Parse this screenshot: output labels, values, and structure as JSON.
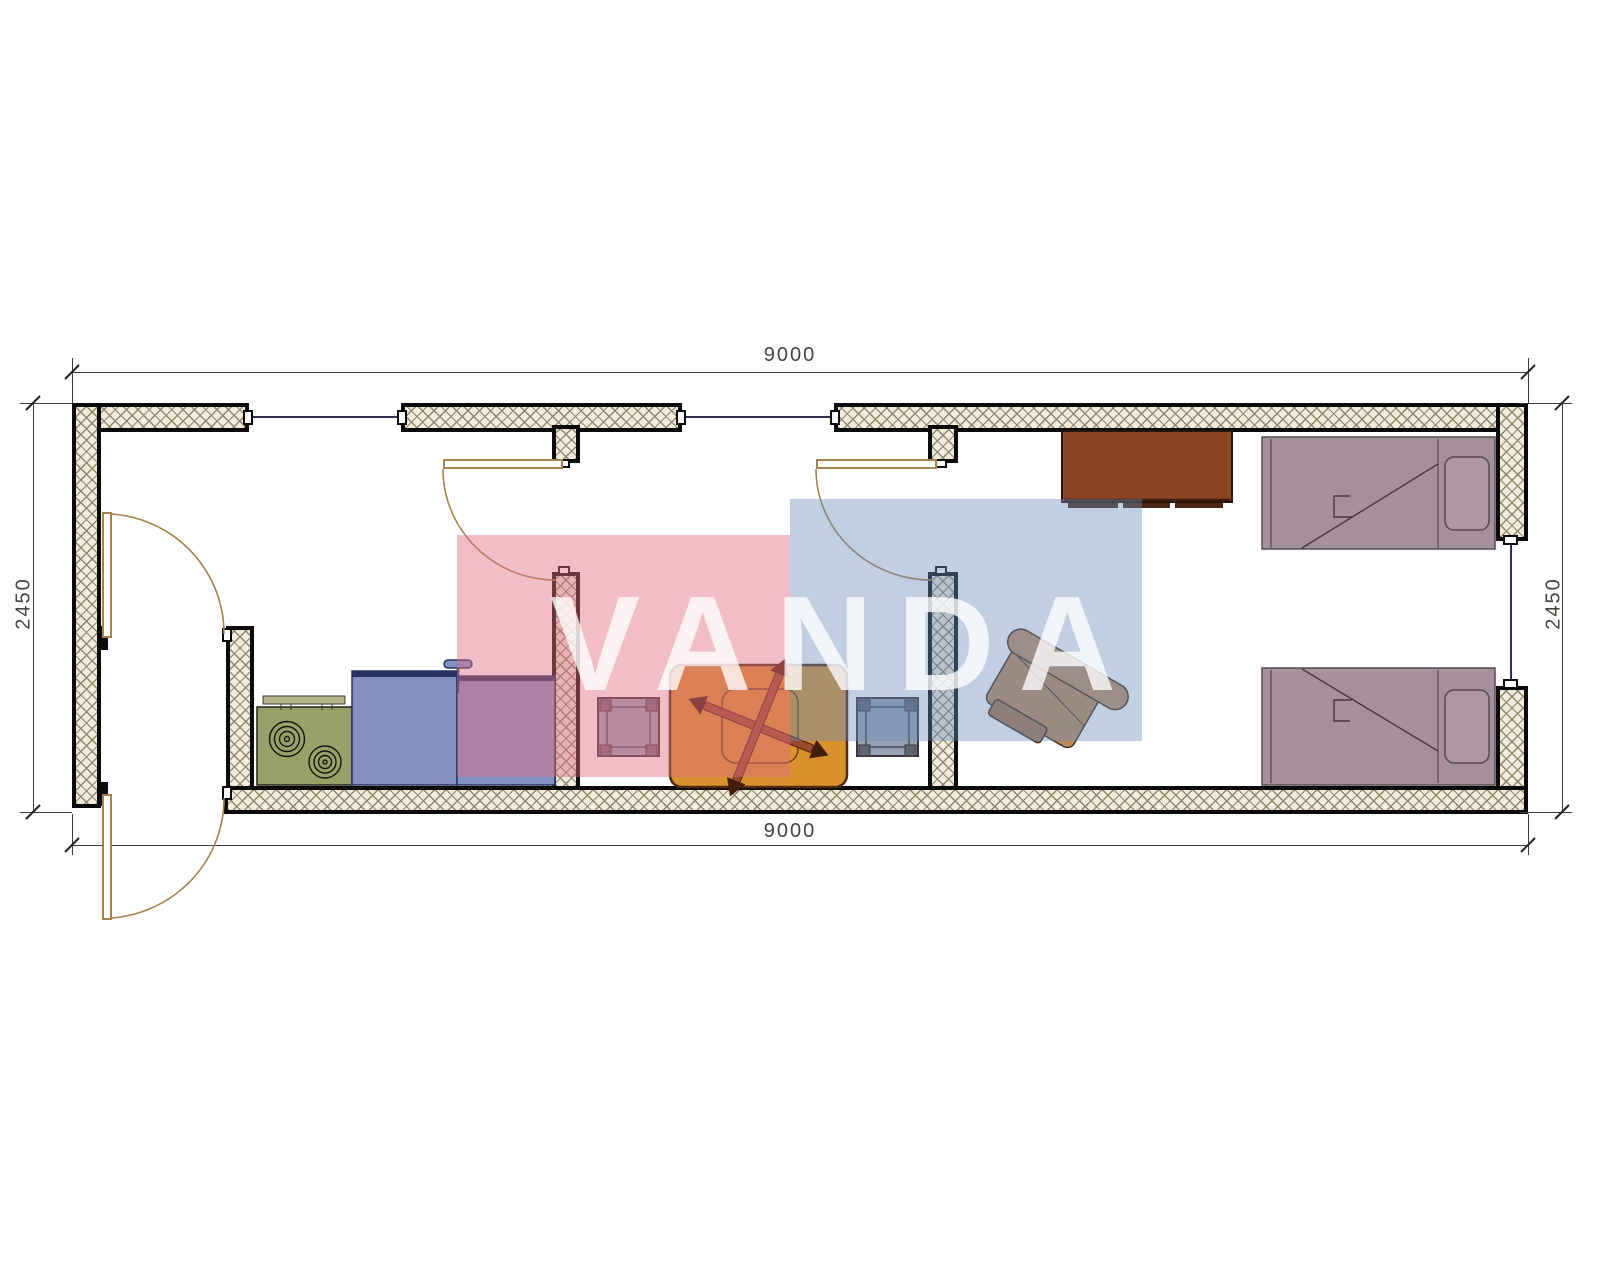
{
  "watermark": {
    "text": "VANDA"
  },
  "dimensions": {
    "top": {
      "label": "9000"
    },
    "bottom": {
      "label": "9000"
    },
    "left": {
      "label": "2450"
    },
    "right": {
      "label": "2450"
    }
  },
  "colors": {
    "wall_fill": "#f0ebdb",
    "hatch_line": "#8f8568",
    "line_dark": "#0a0a0a",
    "dim_line": "#3c3c38",
    "dim_text": "#45453f",
    "door_line": "#a5834e",
    "glass_line": "#2e2e55",
    "stove_fill": "#99a169",
    "shelf_fill": "#b2b58c",
    "cabinet_fill": "#8291c2",
    "cabinet_edge": "#263263",
    "table_fill": "#d9912e",
    "table_edge": "#4f2a10",
    "cross_fill": "#9a4a28",
    "stool_fill": "#97a2b2",
    "stool_edge": "#403440",
    "chair_fill": "#c59067",
    "chair_edge": "#3f2c18",
    "wardrobe_fill": "#8a4423",
    "wardrobe_edge": "#27140a",
    "bed_fill": "#a5909c",
    "bed_edge": "#564852",
    "pillow_fill": "#ac97a3",
    "watermark_pink": "rgba(223,110,134,0.45)",
    "watermark_blue": "rgba(105,140,185,0.42)",
    "watermark_text": "rgba(255,255,255,0.78)"
  }
}
